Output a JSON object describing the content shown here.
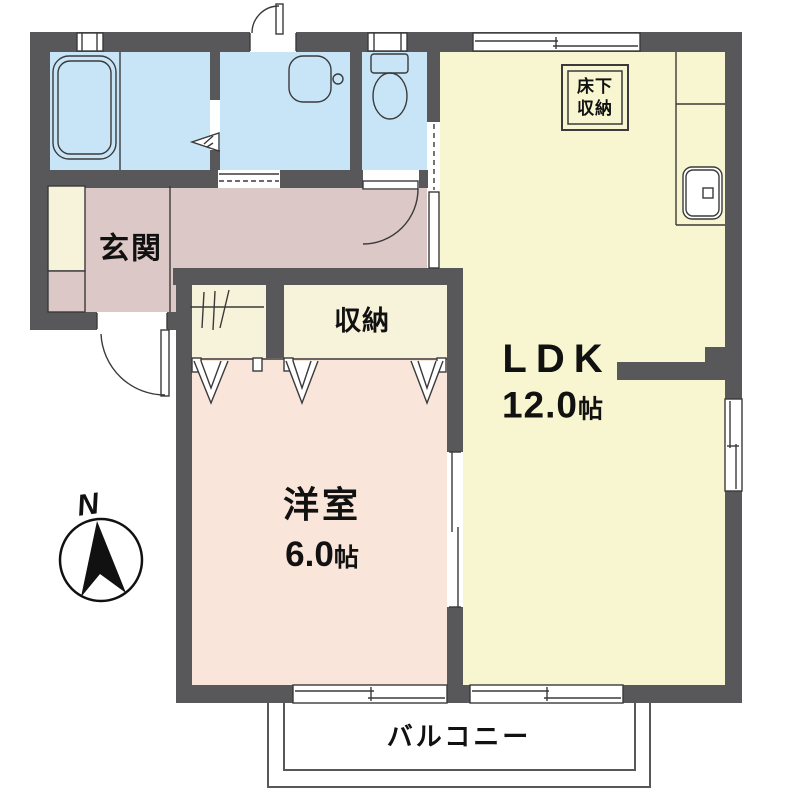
{
  "rooms": {
    "entrance": {
      "label": "玄関"
    },
    "closet": {
      "label": "収納"
    },
    "ldk": {
      "label": "LDK",
      "size_value": "12.0",
      "size_unit": "帖"
    },
    "western_room": {
      "label": "洋室",
      "size_value": "6.0",
      "size_unit": "帖"
    },
    "balcony": {
      "label": "バルコニー"
    },
    "underfloor_storage": {
      "line1": "床下",
      "line2": "収納"
    }
  },
  "compass": {
    "north": "N"
  },
  "colors": {
    "wall": "#58585a",
    "water_room": "#c8e5f8",
    "ldk": "#f8f6d0",
    "hallway": "#dcc8c6",
    "western_room": "#f9e5da",
    "closet": "#f7f2da",
    "line": "#3a3a3a",
    "text": "#111111"
  }
}
